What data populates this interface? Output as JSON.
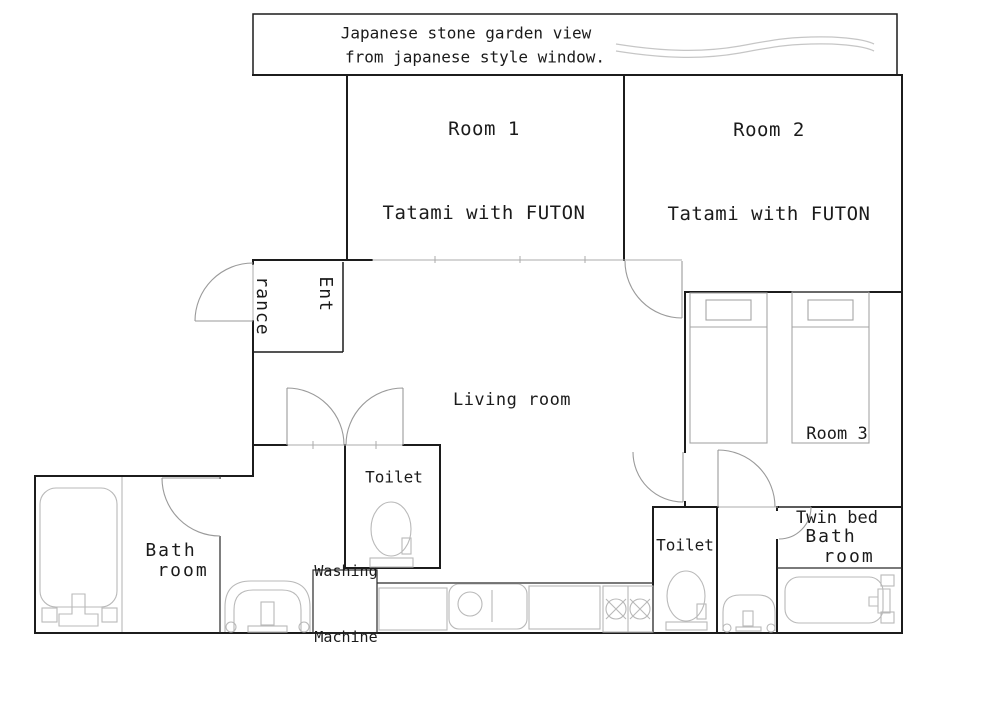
{
  "banner": {
    "line1": "Japanese stone garden view",
    "line2": "from japanese style window."
  },
  "rooms": {
    "room1": {
      "name": "Room 1",
      "desc": "Tatami with FUTON"
    },
    "room2": {
      "name": "Room 2",
      "desc": "Tatami with FUTON"
    },
    "room3": {
      "name": "Room 3",
      "desc": "Twin bed"
    },
    "living": {
      "name": "Living room"
    },
    "entrance": {
      "line1": "Ent",
      "line2": "rance"
    },
    "toilet_left": {
      "name": "Toilet"
    },
    "toilet_right": {
      "name": "Toilet"
    },
    "bath_left": {
      "line1": "Bath",
      "line2": "room"
    },
    "bath_right": {
      "line1": "Bath",
      "line2": "room"
    },
    "washing": {
      "line1": "Washing",
      "line2": "Machine"
    }
  },
  "colors": {
    "wall": "#1c1c1c",
    "door": "#9a9a9a",
    "fixture": "#b9b9b9",
    "wave": "#c6c6c6",
    "background": "#ffffff",
    "text": "#1b1b1b"
  }
}
